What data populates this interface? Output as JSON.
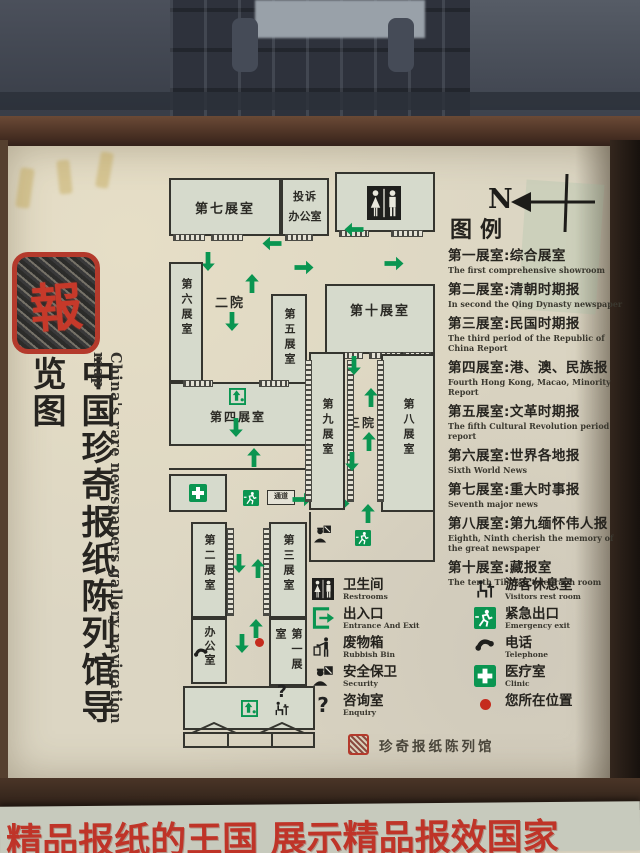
{
  "scene": {
    "banner_text": "精品报纸的王国  展示精品报效国家"
  },
  "board": {
    "seal_char": "報",
    "title_zh": "中国珍奇报纸陈列馆导览图",
    "title_en": "China's rare newspapers gallery navigation map",
    "compass_label": "N",
    "legend_title": "图例",
    "legend_items": [
      {
        "zh": "第一展室:综合展室",
        "en": "The first comprehensive showroom"
      },
      {
        "zh": "第二展室:清朝时期报",
        "en": "In second the Qing Dynasty newspaper"
      },
      {
        "zh": "第三展室:民国时期报",
        "en": "The third period of the Republic of China Report"
      },
      {
        "zh": "第四展室:港、澳、民族报",
        "en": "Fourth Hong Kong, Macao, Minority Report"
      },
      {
        "zh": "第五展室:文革时期报",
        "en": "The fifth Cultural Revolution period report"
      },
      {
        "zh": "第六展室:世界各地报",
        "en": "Sixth World News"
      },
      {
        "zh": "第七展室:重大时事报",
        "en": "Seventh major news"
      },
      {
        "zh": "第八展室:第九缅怀伟人报",
        "en": "Eighth, Ninth cherish the memory of the great newspaper"
      },
      {
        "zh": "第十展室:藏报室",
        "en": "The tenth Tibetan telegraph room"
      }
    ],
    "icon_legend": {
      "left": [
        {
          "zh": "卫生间",
          "en": "Restrooms"
        },
        {
          "zh": "出入口",
          "en": "Entrance And Exit"
        },
        {
          "zh": "废物箱",
          "en": "Rubbish Bin"
        },
        {
          "zh": "安全保卫",
          "en": "Security"
        },
        {
          "zh": "咨询室",
          "en": "Enquiry"
        }
      ],
      "right": [
        {
          "zh": "游客休息室",
          "en": "Visitors rest room"
        },
        {
          "zh": "紧急出口",
          "en": "Emergency exit"
        },
        {
          "zh": "电话",
          "en": "Telephone"
        },
        {
          "zh": "医疗室",
          "en": "Clinic"
        },
        {
          "zh": "您所在位置",
          "en": ""
        }
      ]
    },
    "footer_seal_text": "珍奇报纸陈列馆"
  },
  "plan": {
    "rooms": {
      "room7": "第七展室",
      "complaints_line1": "投诉",
      "complaints_line2": "办公室",
      "room6": "第六展室",
      "courtyard2": "二院",
      "room5": "第五展室",
      "room10": "第十展室",
      "room4": "第四展室",
      "room9": "第九展室",
      "courtyard3": "三院",
      "room8": "第八展室",
      "room2": "第二展室",
      "room3": "第三展室",
      "office": "办公室",
      "room1": "第一展室",
      "passage": "通道"
    },
    "question_glyph": "?"
  },
  "colors": {
    "arrow_green": "#0a9551",
    "seal_red": "#b43a2c",
    "banner_red": "#bf3428",
    "board_cream": "#dcd6c3",
    "room_fill": "#d6dacc"
  }
}
